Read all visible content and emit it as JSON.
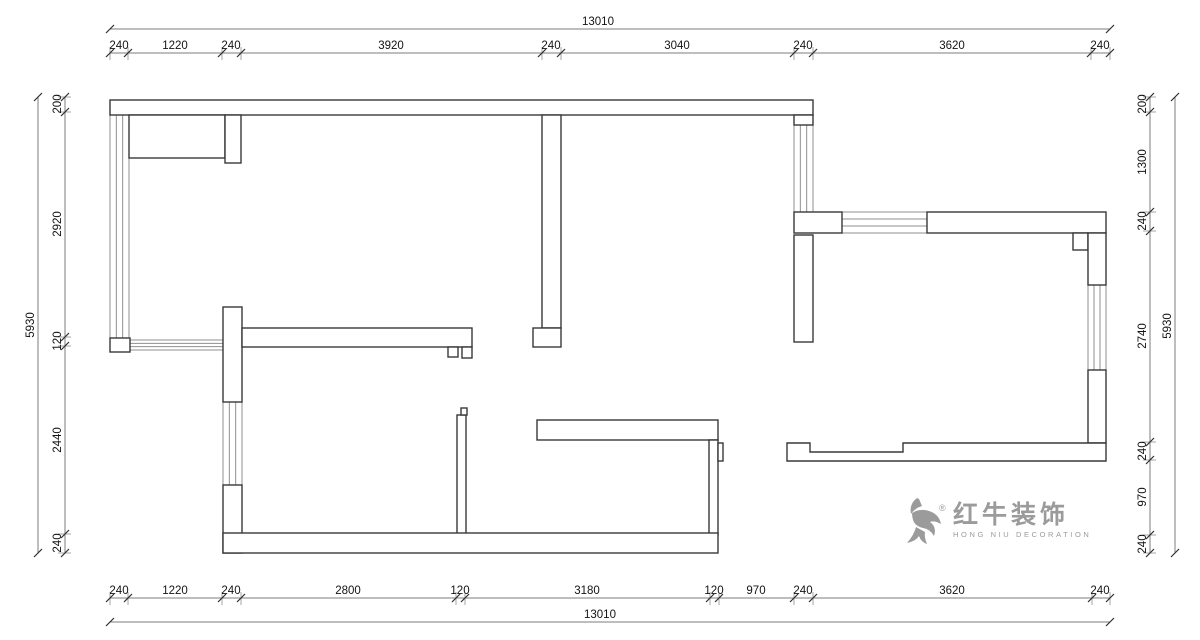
{
  "colors": {
    "background": "#ffffff",
    "wall_line": "#383838",
    "window_line": "#8f8f8f",
    "dim_line": "#7d7d7d",
    "dim_tick": "#2f2f2f",
    "dim_text": "#141414",
    "logo_gray": "#9b9b9b"
  },
  "floorplan": {
    "walls": [
      {
        "x": 110,
        "y": 100,
        "w": 703,
        "h": 15
      },
      {
        "x": 129,
        "y": 115,
        "w": 96,
        "h": 43
      },
      {
        "x": 225,
        "y": 115,
        "w": 16,
        "h": 48
      },
      {
        "x": 542,
        "y": 115,
        "w": 19,
        "h": 213
      },
      {
        "x": 533,
        "y": 328,
        "w": 28,
        "h": 19
      },
      {
        "x": 794,
        "y": 115,
        "w": 19,
        "h": 10
      },
      {
        "x": 794,
        "y": 235,
        "w": 19,
        "h": 107
      },
      {
        "x": 794,
        "y": 212,
        "w": 48,
        "h": 21
      },
      {
        "x": 927,
        "y": 212,
        "w": 179,
        "h": 21
      },
      {
        "x": 1073,
        "y": 233,
        "w": 15,
        "h": 17
      },
      {
        "x": 1088,
        "y": 233,
        "w": 18,
        "h": 52
      },
      {
        "x": 1088,
        "y": 370,
        "w": 18,
        "h": 73
      },
      {
        "x": 110,
        "y": 338,
        "w": 20,
        "h": 14
      },
      {
        "x": 223,
        "y": 307,
        "w": 19,
        "h": 95
      },
      {
        "x": 223,
        "y": 485,
        "w": 19,
        "h": 68
      },
      {
        "x": 242,
        "y": 328,
        "w": 230,
        "h": 19
      },
      {
        "x": 448,
        "y": 347,
        "w": 10,
        "h": 10
      },
      {
        "x": 462,
        "y": 347,
        "w": 10,
        "h": 11
      },
      {
        "x": 457,
        "y": 415,
        "w": 9,
        "h": 122
      },
      {
        "x": 461,
        "y": 408,
        "w": 6,
        "h": 7
      },
      {
        "x": 537,
        "y": 420,
        "w": 181,
        "h": 20
      },
      {
        "x": 709,
        "y": 440,
        "w": 9,
        "h": 95
      },
      {
        "x": 718,
        "y": 443,
        "w": 5,
        "h": 18
      },
      {
        "x": 223,
        "y": 533,
        "w": 495,
        "h": 20
      }
    ],
    "wall_polygons": [
      {
        "points": "787,443 810,443 810,452 903,452 903,443 1106,443 1106,461 787,461"
      }
    ],
    "windows_vertical": [
      {
        "x": 110,
        "y": 115,
        "w": 19,
        "h": 223
      },
      {
        "x": 223,
        "y": 402,
        "w": 19,
        "h": 83
      },
      {
        "x": 794,
        "y": 125,
        "w": 19,
        "h": 87
      },
      {
        "x": 1088,
        "y": 285,
        "w": 18,
        "h": 85
      }
    ],
    "windows_horizontal": [
      {
        "x": 129,
        "y": 340,
        "w": 94,
        "h": 10
      },
      {
        "x": 842,
        "y": 212,
        "w": 85,
        "h": 21
      }
    ]
  },
  "dimensions": {
    "top": {
      "seg_line_y": 53,
      "label_y": 49,
      "boundaries": [
        110,
        128,
        222,
        241,
        542,
        561,
        794,
        813,
        1091,
        1110
      ],
      "labels": [
        {
          "t": "240",
          "x": 119
        },
        {
          "t": "1220",
          "x": 175
        },
        {
          "t": "240",
          "x": 231
        },
        {
          "t": "3920",
          "x": 391
        },
        {
          "t": "240",
          "x": 551
        },
        {
          "t": "3040",
          "x": 677
        },
        {
          "t": "240",
          "x": 803
        },
        {
          "t": "3620",
          "x": 952
        },
        {
          "t": "240",
          "x": 1100
        }
      ],
      "total": {
        "t": "13010",
        "line_y": 29,
        "x1": 110,
        "x2": 1110,
        "lx": 598,
        "ly": 25
      }
    },
    "bottom": {
      "seg_line_y": 598,
      "label_y": 594,
      "boundaries": [
        110,
        128,
        222,
        241,
        456,
        465,
        710,
        719,
        794,
        813,
        1092,
        1110
      ],
      "labels": [
        {
          "t": "240",
          "x": 119
        },
        {
          "t": "1220",
          "x": 175
        },
        {
          "t": "240",
          "x": 231
        },
        {
          "t": "2800",
          "x": 348
        },
        {
          "t": "120",
          "x": 460
        },
        {
          "t": "3180",
          "x": 587
        },
        {
          "t": "120",
          "x": 714
        },
        {
          "t": "970",
          "x": 756
        },
        {
          "t": "240",
          "x": 803
        },
        {
          "t": "3620",
          "x": 952
        },
        {
          "t": "240",
          "x": 1100
        }
      ],
      "total": {
        "t": "13010",
        "line_y": 622,
        "x1": 110,
        "x2": 1110,
        "lx": 600,
        "ly": 618
      }
    },
    "left": {
      "seg_line_x": 65,
      "label_x": 61,
      "boundaries": [
        97,
        112,
        337,
        346,
        534,
        553
      ],
      "labels": [
        {
          "t": "200",
          "y": 104
        },
        {
          "t": "2920",
          "y": 224
        },
        {
          "t": "120",
          "y": 341
        },
        {
          "t": "2440",
          "y": 440
        },
        {
          "t": "240",
          "y": 543
        }
      ],
      "total": {
        "t": "5930",
        "line_x": 38,
        "y1": 97,
        "y2": 553,
        "lx": 34,
        "ly": 325
      }
    },
    "right": {
      "seg_line_x": 1150,
      "label_x": 1146,
      "boundaries": [
        97,
        112,
        212,
        231,
        442,
        460,
        535,
        553
      ],
      "labels": [
        {
          "t": "200",
          "y": 104
        },
        {
          "t": "1300",
          "y": 162
        },
        {
          "t": "240",
          "y": 221
        },
        {
          "t": "2740",
          "y": 336
        },
        {
          "t": "240",
          "y": 451
        },
        {
          "t": "970",
          "y": 497
        },
        {
          "t": "240",
          "y": 544
        }
      ],
      "total": {
        "t": "5930",
        "line_x": 1175,
        "y1": 97,
        "y2": 553,
        "lx": 1171,
        "ly": 326
      }
    }
  },
  "logo": {
    "reg": "®",
    "name_cn": "红牛装饰",
    "name_en": "HONG NIU DECORATION"
  }
}
